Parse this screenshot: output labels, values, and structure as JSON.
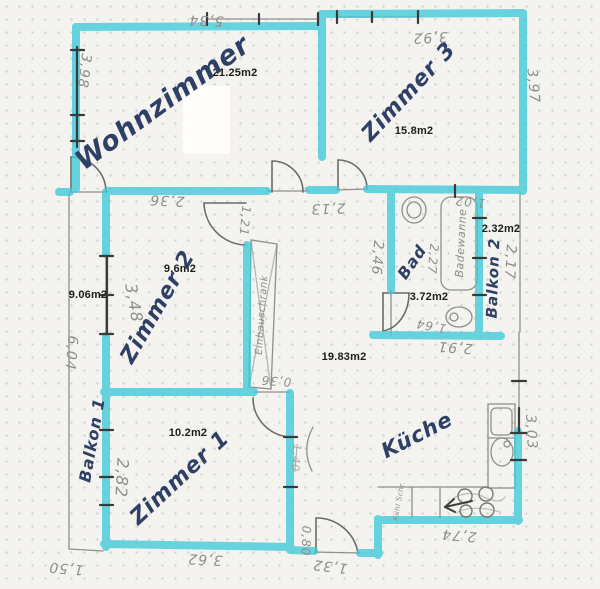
{
  "plan": {
    "colors": {
      "wall_marker": "#3fc9d8",
      "pencil": "#8e8e8a",
      "ink": "#2e4066",
      "paper": "#f4f3f0"
    },
    "rooms": {
      "wohnzimmer": {
        "name": "Wohnzimmer",
        "area": "21.25m2"
      },
      "zimmer3": {
        "name": "Zimmer 3",
        "area": "15.8m2"
      },
      "zimmer2": {
        "name": "Zimmer 2",
        "area": "9.6m2"
      },
      "zimmer1": {
        "name": "Zimmer 1",
        "area": "10.2m2"
      },
      "kueche": {
        "name": "Küche"
      },
      "bad": {
        "name": "Bad",
        "area": "3.72m2"
      },
      "flur": {
        "area": "19.83m2"
      },
      "balkon1": {
        "name": "Balkon 1",
        "area": "9.06m2"
      },
      "balkon2": {
        "name": "Balkon 2",
        "area": "2.32m2"
      }
    },
    "fixtures": {
      "badewanne": "Badewanne",
      "einbauschrank": "Einbauschrank",
      "kuehlschrank": "Kühl Schr."
    },
    "dimensions": {
      "wz_top": "5,34",
      "wz_left": "3,98",
      "z3_top": "3,92",
      "z3_right": "3,97",
      "z2_top": "2,36",
      "z2_height": "3,48",
      "z2_door": "1,21",
      "hall_top": "2,13",
      "balkon2_top": "1,02",
      "balkon2_right": "2,17",
      "bad_left": "2,46",
      "bad_inner": "2,27",
      "bad_bottom": "2,91",
      "wc": "1,64",
      "balkon1_len": "6,04",
      "balkon1_bottom": "1,50",
      "schrank_depth": "0,36",
      "z1_left": "2,82",
      "z1_bottom": "3,62",
      "z1_right": "1,40",
      "kueche_right": "3,03",
      "kueche_bottom": "2,74",
      "step": "0,80",
      "entry": "1,32"
    }
  }
}
